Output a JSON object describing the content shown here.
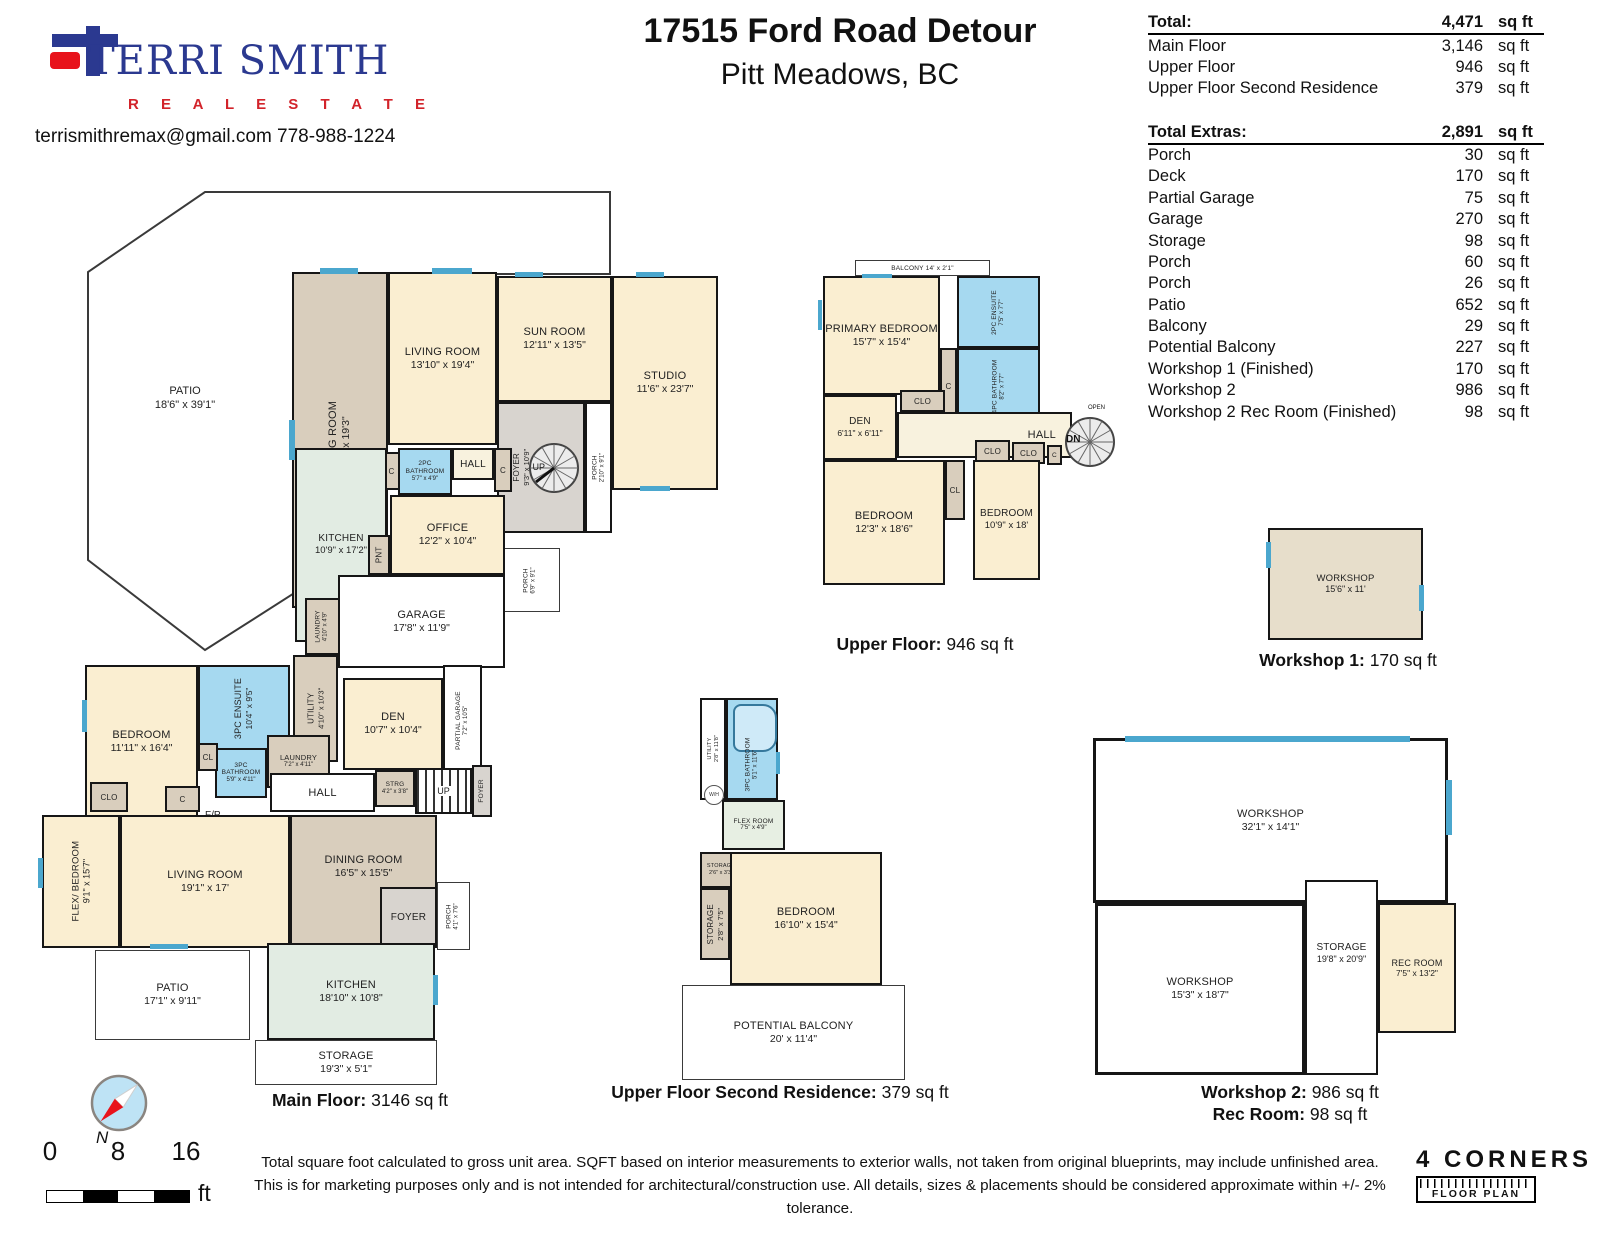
{
  "header": {
    "brand": {
      "name": "TERRI SMITH",
      "tagline": "R E A L   E S T A T E",
      "contact": "terrismithremax@gmail.com   778-988-1224"
    },
    "address_line1": "17515 Ford Road Detour",
    "address_line2": "Pitt Meadows, BC"
  },
  "summary": {
    "total": {
      "label": "Total:",
      "value": "4,471",
      "unit": "sq ft"
    },
    "floors": [
      {
        "label": "Main Floor",
        "value": "3,146",
        "unit": "sq ft"
      },
      {
        "label": "Upper Floor",
        "value": "946",
        "unit": "sq ft"
      },
      {
        "label": "Upper Floor Second Residence",
        "value": "379",
        "unit": "sq ft"
      }
    ],
    "extras_total": {
      "label": "Total Extras:",
      "value": "2,891",
      "unit": "sq ft"
    },
    "extras": [
      {
        "label": "Porch",
        "value": "30",
        "unit": "sq ft"
      },
      {
        "label": "Deck",
        "value": "170",
        "unit": "sq ft"
      },
      {
        "label": "Partial Garage",
        "value": "75",
        "unit": "sq ft"
      },
      {
        "label": "Garage",
        "value": "270",
        "unit": "sq ft"
      },
      {
        "label": "Storage",
        "value": "98",
        "unit": "sq ft"
      },
      {
        "label": "Porch",
        "value": "60",
        "unit": "sq ft"
      },
      {
        "label": "Porch",
        "value": "26",
        "unit": "sq ft"
      },
      {
        "label": "Patio",
        "value": "652",
        "unit": "sq ft"
      },
      {
        "label": "Balcony",
        "value": "29",
        "unit": "sq ft"
      },
      {
        "label": "Potential Balcony",
        "value": "227",
        "unit": "sq ft"
      },
      {
        "label": "Workshop 1 (Finished)",
        "value": "170",
        "unit": "sq ft"
      },
      {
        "label": "Workshop 2",
        "value": "986",
        "unit": "sq ft"
      },
      {
        "label": "Workshop 2 Rec Room (Finished)",
        "value": "98",
        "unit": "sq ft"
      }
    ]
  },
  "plans": {
    "main": {
      "caption_label": "Main Floor:",
      "caption_value": "3146 sq ft",
      "rooms": {
        "patio_upper": {
          "label": "PATIO",
          "dims": "18'6\" x 39'1\""
        },
        "dining_upper": {
          "label": "DINING ROOM",
          "dims": "11' x 19'3\""
        },
        "living_upper": {
          "label": "LIVING ROOM",
          "dims": "13'10\" x 19'4\""
        },
        "sunroom": {
          "label": "SUN ROOM",
          "dims": "12'11\" x 13'5\""
        },
        "studio": {
          "label": "STUDIO",
          "dims": "11'6\" x 23'7\""
        },
        "foyer_spiral": {
          "label": "FOYER",
          "dims": "9'3\" x 10'9\""
        },
        "up_spiral": {
          "label": "UP"
        },
        "porch_side": {
          "label": "PORCH",
          "dims": "2'10\" x 9'1\""
        },
        "porch_angled": {
          "label": "PORCH",
          "dims": "6'9\" x 9'1\""
        },
        "bath2pc": {
          "label": "2PC BATHROOM",
          "dims": "5'7\" x 4'9\""
        },
        "hall_upper": {
          "label": "HALL"
        },
        "closet_c1": {
          "label": "C"
        },
        "closet_c2": {
          "label": "C"
        },
        "kitchen_upper": {
          "label": "KITCHEN",
          "dims": "10'9\" x 17'2\""
        },
        "office": {
          "label": "OFFICE",
          "dims": "12'2\" x 10'4\""
        },
        "pantry": {
          "label": "PNT"
        },
        "garage": {
          "label": "GARAGE",
          "dims": "17'8\" x 11'9\""
        },
        "laundry_small": {
          "label": "LAUNDRY",
          "dims": "4'10\" x 4'9\""
        },
        "utility": {
          "label": "UTILITY",
          "dims": "4'10\" x 10'3\""
        },
        "ensuite3pc": {
          "label": "3PC ENSUITE",
          "dims": "10'4\" x 9'5\""
        },
        "bedroom_main": {
          "label": "BEDROOM",
          "dims": "11'11\" x 16'4\""
        },
        "den": {
          "label": "DEN",
          "dims": "10'7\" x 10'4\""
        },
        "partial_garage": {
          "label": "PARTIAL GARAGE",
          "dims": "7'2\" x 10'5\""
        },
        "bath3pc": {
          "label": "3PC BATHROOM",
          "dims": "5'9\" x 4'11\""
        },
        "cl": {
          "label": "CL"
        },
        "laundry2": {
          "label": "LAUNDRY",
          "dims": "7'2\" x 4'11\""
        },
        "hall_lower": {
          "label": "HALL"
        },
        "strg": {
          "label": "STRG",
          "dims": "4'2\" x 3'8\""
        },
        "up": {
          "label": "UP"
        },
        "foyer_stairs": {
          "label": "FOYER"
        },
        "clo": {
          "label": "CLO"
        },
        "closet_c3": {
          "label": "C"
        },
        "fp": {
          "label": "F/P"
        },
        "flex_bedroom": {
          "label": "FLEX/ BEDROOM",
          "dims": "9'1\" x 15'7\""
        },
        "living_lower": {
          "label": "LIVING ROOM",
          "dims": "19'1\" x 17'"
        },
        "dining_lower": {
          "label": "DINING ROOM",
          "dims": "16'5\" x 15'5\""
        },
        "foyer_lower": {
          "label": "FOYER"
        },
        "porch_lower": {
          "label": "PORCH",
          "dims": "4'1\" x 7'6\""
        },
        "patio_lower": {
          "label": "PATIO",
          "dims": "17'1\" x 9'11\""
        },
        "kitchen_lower": {
          "label": "KITCHEN",
          "dims": "18'10\" x 10'8\""
        },
        "storage_lower": {
          "label": "STORAGE",
          "dims": "19'3\" x 5'1\""
        }
      }
    },
    "upper": {
      "caption_label": "Upper Floor:",
      "caption_value": "946 sq ft",
      "rooms": {
        "balcony": {
          "label": "BALCONY",
          "dims": "14' x 2'1\""
        },
        "primary": {
          "label": "PRIMARY BEDROOM",
          "dims": "15'7\" x 15'4\""
        },
        "ensuite2pc": {
          "label": "2PC ENSUITE",
          "dims": "7'5\" x 7'7\""
        },
        "bath4pc": {
          "label": "4PC BATHROOM",
          "dims": "8'2\" x 7'7\""
        },
        "c_mid": {
          "label": "C"
        },
        "den": {
          "label": "DEN",
          "dims": "6'11\" x 6'11\""
        },
        "clo1": {
          "label": "CLO"
        },
        "hall": {
          "label": "HALL"
        },
        "open": {
          "label": "OPEN"
        },
        "dn": {
          "label": "DN"
        },
        "clo2": {
          "label": "CLO"
        },
        "clo3": {
          "label": "CLO"
        },
        "c2": {
          "label": "C"
        },
        "cl": {
          "label": "CL"
        },
        "bedroom1": {
          "label": "BEDROOM",
          "dims": "12'3\" x 18'6\""
        },
        "bedroom2": {
          "label": "BEDROOM",
          "dims": "10'9\" x 18'"
        }
      }
    },
    "second": {
      "caption_label": "Upper Floor Second Residence:",
      "caption_value": "379 sq ft",
      "rooms": {
        "utility": {
          "label": "UTILITY",
          "dims": "2'8\" x 11'8\""
        },
        "bath3pc": {
          "label": "3PC BATHROOM",
          "dims": "5'1\" x 11'6\""
        },
        "wh": {
          "label": "W/H"
        },
        "flexroom": {
          "label": "FLEX ROOM",
          "dims": "7'5\" x 4'9\""
        },
        "storage_small": {
          "label": "STORAGE",
          "dims": "2'6\" x 3'3\""
        },
        "storage": {
          "label": "STORAGE",
          "dims": "2'8\" x 7'5\""
        },
        "bedroom": {
          "label": "BEDROOM",
          "dims": "16'10\" x 15'4\""
        },
        "balcony": {
          "label": "POTENTIAL BALCONY",
          "dims": "20' x 11'4\""
        }
      }
    },
    "workshop1": {
      "caption_label": "Workshop 1:",
      "caption_value": "170 sq ft",
      "rooms": {
        "workshop": {
          "label": "WORKSHOP",
          "dims": "15'6\" x 11'"
        }
      }
    },
    "workshop2": {
      "caption_label": "Workshop 2:",
      "caption_value": "986 sq ft",
      "caption2_label": "Rec Room:",
      "caption2_value": "98 sq ft",
      "rooms": {
        "workshop_top": {
          "label": "WORKSHOP",
          "dims": "32'1\" x 14'1\""
        },
        "workshop_bottom": {
          "label": "WORKSHOP",
          "dims": "15'3\" x 18'7\""
        },
        "storage": {
          "label": "STORAGE",
          "dims": "19'8\" x 20'9\""
        },
        "recroom": {
          "label": "REC ROOM",
          "dims": "7'5\" x 13'2\""
        }
      }
    }
  },
  "footer": {
    "scale": {
      "t0": "0",
      "t8": "8",
      "t16": "16",
      "unit": "ft"
    },
    "compass_label": "N",
    "disclaimer_line1": "Total square foot calculated to gross unit area. SQFT based on interior measurements to exterior walls, not taken from original blueprints, may include unfinished area.",
    "disclaimer_line2": "This is for marketing purposes only and is not intended for architectural/construction use.  All details, sizes & placements should be considered approximate within +/- 2%  tolerance.",
    "brand_line1": "4 CORNERS",
    "brand_line2": "FLOOR PLAN"
  }
}
